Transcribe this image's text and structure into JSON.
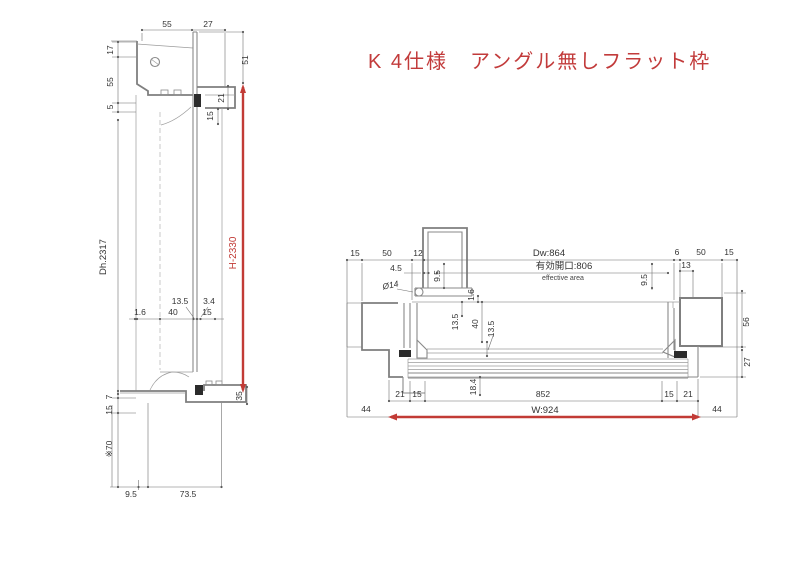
{
  "title": "K 4仕様　アングル無しフラット枠",
  "colors": {
    "line": "#8a8a8a",
    "dim_text": "#333333",
    "accent_red": "#c23b36"
  },
  "left_view": {
    "dims": {
      "top_55": "55",
      "top_27": "27",
      "l_17": "17",
      "l_55": "55",
      "l_5": "5",
      "r_51": "51",
      "r_21": "21",
      "r_15": "15",
      "dh": "Dh.2317",
      "h": "H-2330",
      "m_135": "13.5",
      "m_34": "3.4",
      "m_16": "1.6",
      "m_40": "40",
      "m_15": "15",
      "b_7": "7",
      "b_15": "15",
      "b_70": "※70",
      "b_35": "35",
      "b_95": "9.5",
      "b_735": "73.5"
    }
  },
  "right_view": {
    "labels": {
      "dw": "Dw:864",
      "opening": "有効開口:806",
      "effective": "effective area",
      "w": "W:924"
    },
    "dims": {
      "tl_15": "15",
      "tl_50": "50",
      "tl_12": "12",
      "tl_45": "4.5",
      "phi": "Ø14",
      "tl_95": "9.5",
      "m_16": "1.6",
      "tr_6": "6",
      "tr_50": "50",
      "tr_15": "15",
      "tr_13": "13",
      "tr_95": "9.5",
      "tr_56": "56",
      "tr_27": "27",
      "m_135a": "13.5",
      "m_40": "40",
      "m_135b": "13.5",
      "m_184": "18.4",
      "bl_21": "21",
      "bl_15": "15",
      "b_852": "852",
      "br_15": "15",
      "br_21": "21",
      "bl_44": "44",
      "br_44": "44"
    }
  }
}
